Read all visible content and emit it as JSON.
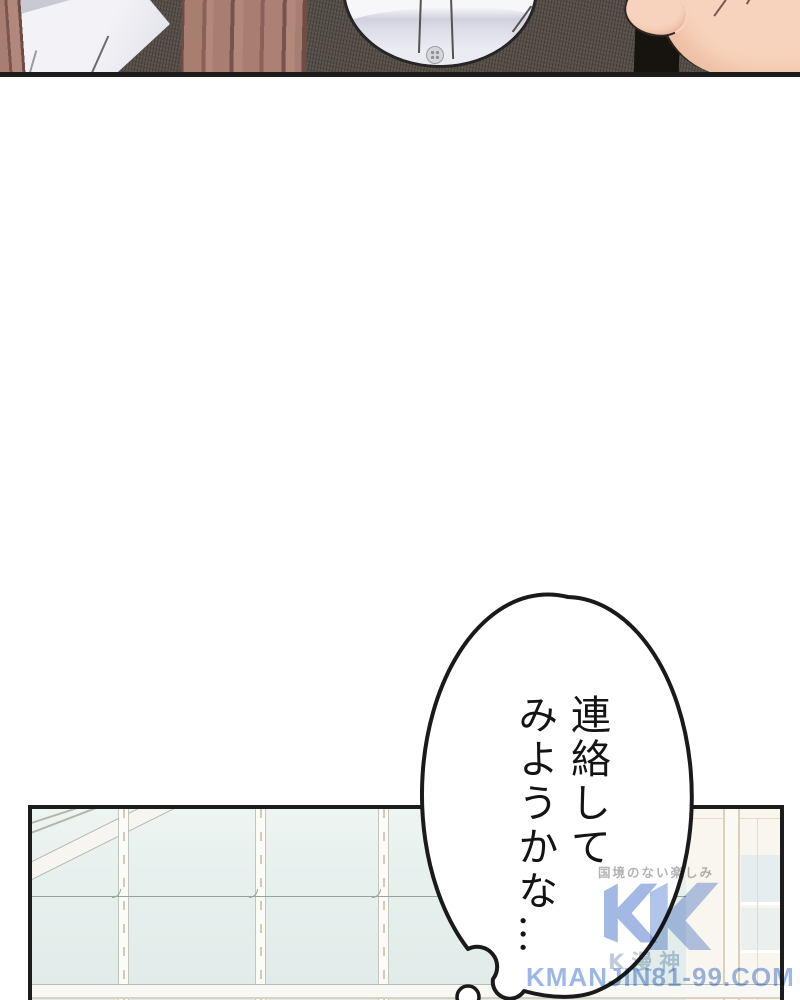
{
  "page": {
    "width": 800,
    "height": 1000,
    "background": "#ffffff",
    "type": "manga-page"
  },
  "bubble": {
    "type": "thought-bubble",
    "text": "連絡して\nみようかな…"
  },
  "watermark": {
    "tagline": "国境のない楽しみ",
    "logo_letter": "K",
    "site_name": "K漫神",
    "url": "KMANJIN81-99.COM"
  },
  "colors": {
    "panel_border": "#1c1c1c",
    "bubble_outline": "#1a1a1a",
    "watermark_blue": "#4e79cc",
    "glass": "#e6f0ed",
    "cardigan": "#57504a",
    "hair": "#a87d72",
    "skin": "#f7d3bd",
    "strap": "#17140f"
  }
}
